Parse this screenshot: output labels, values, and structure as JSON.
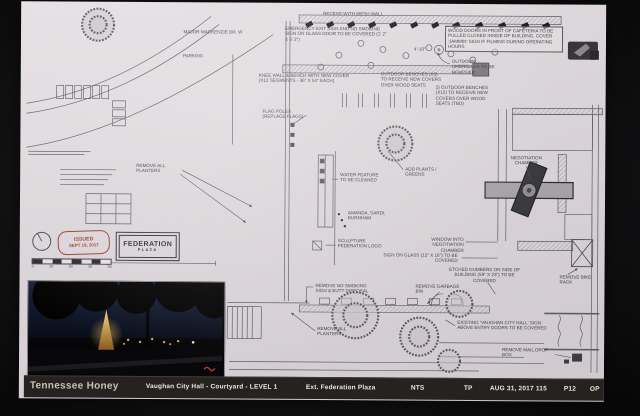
{
  "annotations": {
    "top_recess": "RECESS WITH MESH WALL",
    "emergency_exit": "EMERGENCY EXIT SIGN AND NO SMOKING SIGN ON GLASS DOOR TO BE COVERED (1' 2\" X 5' 2\")",
    "wood_doors": "WOOD DOORS IN FRONT OF CAFETERIA TO BE PULLED CLOSED INSIDE OF BUILDING. COVER 'JAMMIN' SIGN IF FILMING DURING OPERATING HOURS",
    "umbrellas": "OUTDOOR UMBRELLAS TO BE REMOVED",
    "dim1": "4'-10\"",
    "knee_wall": "KNEE WALL & BENCH WITH NEW COVER (X12 SEGMENTS - 36\" X 54\" EACH)",
    "benches5": "OUTDOOR BENCHES (X5) TO RECEIVE NEW COVERS OVER WOOD SEATS",
    "benches12": "2) OUTDOOR BENCHES (X12) TO RECEIVE NEW COVERS OVER WOOD SEATS (TBD)",
    "street": "MAJOR MACKENZIE DR. W",
    "parking": "PARKING",
    "flag_poles": "FLAG POLES (REPLACE FLAGS)",
    "remove_planters_left": "REMOVE ALL PLANTERS",
    "water_feature": "WATER FEATURE TO BE CLEANED",
    "add_plants": "ADD PLANTS / GREENS",
    "names": "AMANDA, SARDI, BURNHAM",
    "sculpture": "SCULPTURE FEDERATION LOGO",
    "window_chamber": "WINDOW INTO NEGOTIATION CHAMBER",
    "glass_sign": "SIGN ON GLASS (12\" X 16\") TO BE COVERED",
    "chamber": "NEGOTIATION CHAMBER",
    "etched": "ETCHED NUMBERS ON SIDE OF BUILDING (59\" X 23\") TO BE COVERED",
    "bike_rack": "REMOVE BIKE RACK",
    "no_smoking": "REMOVE NO SMOKING SIGN & BUTT DISPOSAL",
    "garbage": "REMOVE GARBAGE BIN",
    "planters_bottom": "REMOVE ALL PLANTERS",
    "existing_sign": "EXISTING 'VAUGHAN CITY HALL' SIGN ABOVE ENTRY DOORS TO BE COVERED",
    "mail": "REMOVE MAIL DROP BOX"
  },
  "stamp": {
    "line1": "ISSUED",
    "line2": "SEPT 19, 2017"
  },
  "plaza_box": {
    "line1": "FEDERATION",
    "line2": "PLAZA"
  },
  "scalebar": {
    "ticks": [
      "0",
      "10",
      "20",
      "30",
      "40"
    ]
  },
  "titlebar": {
    "studio": "Tennessee Honey",
    "project": "Vaughan City Hall - Courtyard - LEVEL 1",
    "sheet_title": "Ext. Federation Plaza",
    "scale": "NTS",
    "initials": "TP",
    "date": "AUG 31, 2017",
    "number": "115",
    "page": "P12",
    "code": "OP"
  },
  "colors": {
    "sheet": "#dbd6d9",
    "line": "#5c5c66",
    "stamp_red": "#a63b31",
    "bar_bg": "#262220",
    "bar_text": "#ece7df"
  }
}
